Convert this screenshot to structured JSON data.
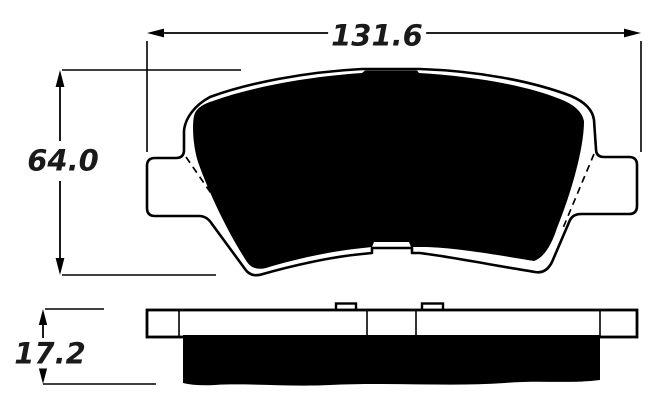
{
  "page": {
    "background_color": "#ffffff",
    "line_color": "#000000",
    "text_color": "#1a1a1a"
  },
  "drawing": {
    "views": {
      "front_view": "brake-pad-front-profile",
      "side_view": "brake-pad-side-profile"
    },
    "dimensions": {
      "width": {
        "value": "131.6"
      },
      "height": {
        "value": "64.0"
      },
      "thickness": {
        "value": "17.2"
      }
    }
  }
}
